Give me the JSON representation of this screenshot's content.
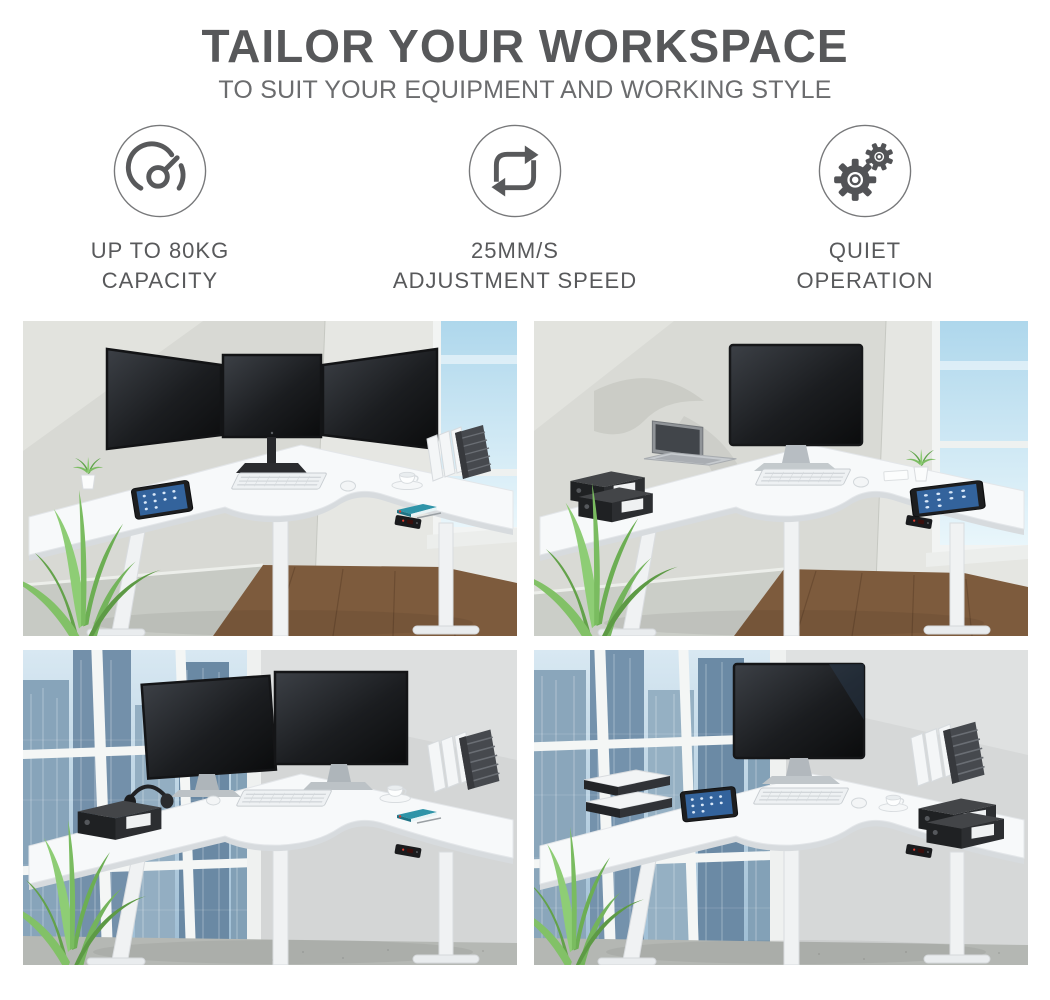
{
  "header": {
    "title": "TAILOR YOUR WORKSPACE",
    "subtitle": "TO SUIT YOUR EQUIPMENT AND WORKING STYLE"
  },
  "features": [
    {
      "icon": "speedometer-icon",
      "line1": "UP TO 80KG",
      "line2": "CAPACITY"
    },
    {
      "icon": "cycle-arrows-icon",
      "line1": "25MM/S",
      "line2": "ADJUSTMENT SPEED"
    },
    {
      "icon": "gears-icon",
      "line1": "QUIET",
      "line2": "OPERATION"
    }
  ],
  "gallery": [
    {
      "id": "triple-monitor-setup",
      "description": "White corner standing desk with triple-monitor arm, keyboard, tablet and file holders beside a bright window"
    },
    {
      "id": "monitor-and-laptop-setup",
      "description": "White corner standing desk with large monitor, open laptop, binders and tablet beside a bright window"
    },
    {
      "id": "dual-monitor-setup",
      "description": "White corner standing desk with dual monitors, headphones and binder in front of a city-view window"
    },
    {
      "id": "single-monitor-setup",
      "description": "White corner standing desk with single monitor, letter trays, tablet and binders in front of a city-view window"
    }
  ],
  "colors": {
    "heading": "#57585a",
    "subheading": "#6b6c6e",
    "label": "#58595b",
    "icon_stroke": "#58595b",
    "background": "#ffffff",
    "desk_top": "#f7f9fa",
    "accent_led": "#e23d30"
  }
}
